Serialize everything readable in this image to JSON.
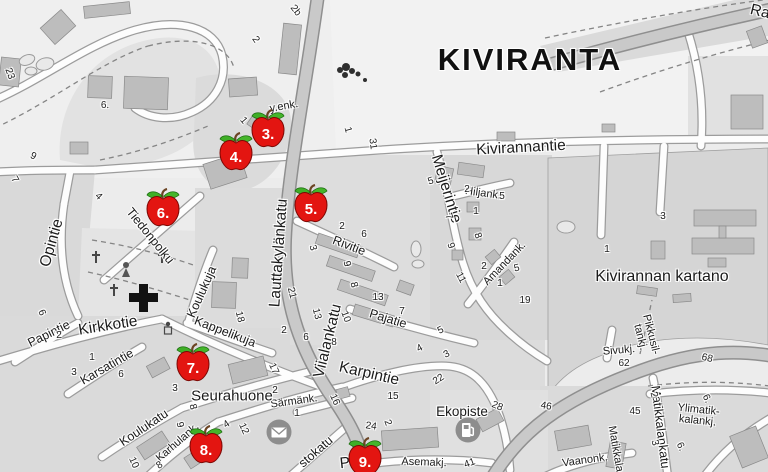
{
  "district": {
    "title": "KIVIRANTA"
  },
  "colors": {
    "apple_red": "#e31511",
    "apple_outline": "#7c0703",
    "leaf_green": "#45b52b",
    "marker_text": "#ffffff",
    "major_road": "#c9c9c9",
    "minor_road": "#fdfdfd",
    "label_text": "#1b1b1b",
    "icon_circle_gray": "#8d8d8d"
  },
  "markers": [
    {
      "num": "3.",
      "x": 268,
      "y": 129
    },
    {
      "num": "4.",
      "x": 236,
      "y": 152
    },
    {
      "num": "5.",
      "x": 311,
      "y": 204
    },
    {
      "num": "6.",
      "x": 163,
      "y": 208
    },
    {
      "num": "7.",
      "x": 193,
      "y": 363
    },
    {
      "num": "8.",
      "x": 206,
      "y": 445
    },
    {
      "num": "9.",
      "x": 365,
      "y": 457
    }
  ],
  "street_labels": [
    {
      "text": "Kivirannantie",
      "x": 521,
      "y": 148,
      "rot": -3,
      "kind": "major"
    },
    {
      "text": "Ra",
      "x": 760,
      "y": 12,
      "rot": 14,
      "kind": "major"
    },
    {
      "text": "Meijerintie",
      "x": 446,
      "y": 189,
      "rot": 73,
      "kind": "major"
    },
    {
      "text": "Hiljank.",
      "x": 483,
      "y": 194,
      "rot": 8,
      "kind": "small"
    },
    {
      "text": "Amandank.",
      "x": 505,
      "y": 264,
      "rot": -46,
      "kind": "small"
    },
    {
      "text": "Kivirannan kartano",
      "x": 662,
      "y": 277,
      "rot": 0,
      "kind": "kartano"
    },
    {
      "text": "Lauttakylänkatu",
      "x": 279,
      "y": 253,
      "rot": -86,
      "kind": "major"
    },
    {
      "text": "Rivitie",
      "x": 349,
      "y": 246,
      "rot": 21,
      "kind": "minor"
    },
    {
      "text": "Pajatie",
      "x": 388,
      "y": 319,
      "rot": 17,
      "kind": "minor"
    },
    {
      "text": "Viialankatu",
      "x": 328,
      "y": 341,
      "rot": -76,
      "kind": "major"
    },
    {
      "text": "Karpintie",
      "x": 369,
      "y": 374,
      "rot": 13,
      "kind": "major"
    },
    {
      "text": "Opintie",
      "x": 52,
      "y": 243,
      "rot": -74,
      "kind": "major"
    },
    {
      "text": "Tiedonpolku",
      "x": 150,
      "y": 236,
      "rot": 51,
      "kind": "minor"
    },
    {
      "text": "Kirkkotie",
      "x": 108,
      "y": 326,
      "rot": -9,
      "kind": "major"
    },
    {
      "text": "Papintie",
      "x": 49,
      "y": 334,
      "rot": -26,
      "kind": "minor"
    },
    {
      "text": "Karsatintie",
      "x": 107,
      "y": 367,
      "rot": -30,
      "kind": "minor"
    },
    {
      "text": "Koulukuja",
      "x": 202,
      "y": 292,
      "rot": -66,
      "kind": "minor"
    },
    {
      "text": "Kappelikuja",
      "x": 225,
      "y": 332,
      "rot": 21,
      "kind": "minor"
    },
    {
      "text": "Koulukatu",
      "x": 144,
      "y": 428,
      "rot": -34,
      "kind": "minor"
    },
    {
      "text": "Karhulank.",
      "x": 178,
      "y": 443,
      "rot": -41,
      "kind": "small"
    },
    {
      "text": "Särmänk.",
      "x": 294,
      "y": 402,
      "rot": -8,
      "kind": "small"
    },
    {
      "text": "Seurahuone",
      "x": 232,
      "y": 396,
      "rot": 0,
      "kind": "poilg"
    },
    {
      "text": "Ekopiste",
      "x": 462,
      "y": 412,
      "rot": 0,
      "kind": "poi"
    },
    {
      "text": "Asemakj.",
      "x": 424,
      "y": 463,
      "rot": 2,
      "kind": "small"
    },
    {
      "text": "y.enk.",
      "x": 284,
      "y": 107,
      "rot": -10,
      "kind": "small"
    },
    {
      "text": "Sivukj.",
      "x": 619,
      "y": 351,
      "rot": -5,
      "kind": "small"
    },
    {
      "text": "Pikkusil-\ntankj.",
      "x": 645,
      "y": 336,
      "rot": 76,
      "kind": "small"
    },
    {
      "text": "Matikkalankatu",
      "x": 660,
      "y": 427,
      "rot": 83,
      "kind": "minor"
    },
    {
      "text": "Matikkala",
      "x": 615,
      "y": 449,
      "rot": 80,
      "kind": "small"
    },
    {
      "text": "Ylimatik-\nkalankj.",
      "x": 698,
      "y": 416,
      "rot": 6,
      "kind": "small"
    },
    {
      "text": "Vaanonk.",
      "x": 585,
      "y": 461,
      "rot": -8,
      "kind": "small"
    },
    {
      "text": "Pol",
      "x": 351,
      "y": 463,
      "rot": -6,
      "kind": "major"
    },
    {
      "text": "stokatu",
      "x": 316,
      "y": 452,
      "rot": -41,
      "kind": "minor"
    }
  ],
  "house_numbers": [
    {
      "text": "2b",
      "x": 295,
      "y": 11,
      "rot": 52
    },
    {
      "text": "2",
      "x": 255,
      "y": 40,
      "rot": 55
    },
    {
      "text": "23",
      "x": 9,
      "y": 74,
      "rot": 70
    },
    {
      "text": "6.",
      "x": 105,
      "y": 106,
      "rot": 0
    },
    {
      "text": "9",
      "x": 33,
      "y": 157,
      "rot": 25
    },
    {
      "text": "7",
      "x": 14,
      "y": 180,
      "rot": 60
    },
    {
      "text": "4",
      "x": 98,
      "y": 197,
      "rot": 45
    },
    {
      "text": "1",
      "x": 243,
      "y": 121,
      "rot": 50
    },
    {
      "text": "1",
      "x": 347,
      "y": 130,
      "rot": 75
    },
    {
      "text": "31",
      "x": 372,
      "y": 144,
      "rot": 82
    },
    {
      "text": "5",
      "x": 431,
      "y": 182,
      "rot": -18
    },
    {
      "text": "2",
      "x": 467,
      "y": 190,
      "rot": 0
    },
    {
      "text": "5",
      "x": 502,
      "y": 197,
      "rot": 0
    },
    {
      "text": "1",
      "x": 476,
      "y": 212,
      "rot": 0
    },
    {
      "text": "7",
      "x": 448,
      "y": 217,
      "rot": 70
    },
    {
      "text": "8",
      "x": 477,
      "y": 236,
      "rot": 70
    },
    {
      "text": "9",
      "x": 450,
      "y": 246,
      "rot": 70
    },
    {
      "text": "2",
      "x": 484,
      "y": 267,
      "rot": 0
    },
    {
      "text": "5",
      "x": 517,
      "y": 269,
      "rot": -12
    },
    {
      "text": "11",
      "x": 460,
      "y": 278,
      "rot": 62
    },
    {
      "text": "1",
      "x": 500,
      "y": 284,
      "rot": 0
    },
    {
      "text": "19",
      "x": 525,
      "y": 301,
      "rot": 0
    },
    {
      "text": "3",
      "x": 663,
      "y": 217,
      "rot": 0
    },
    {
      "text": "1",
      "x": 607,
      "y": 250,
      "rot": 0
    },
    {
      "text": "2",
      "x": 342,
      "y": 227,
      "rot": 0
    },
    {
      "text": "6",
      "x": 364,
      "y": 235,
      "rot": 0
    },
    {
      "text": "3",
      "x": 312,
      "y": 248,
      "rot": 76
    },
    {
      "text": "9",
      "x": 346,
      "y": 264,
      "rot": 76
    },
    {
      "text": "8",
      "x": 353,
      "y": 285,
      "rot": 76
    },
    {
      "text": "21",
      "x": 291,
      "y": 293,
      "rot": 76
    },
    {
      "text": "13",
      "x": 378,
      "y": 298,
      "rot": 0
    },
    {
      "text": "13",
      "x": 316,
      "y": 314,
      "rot": 76
    },
    {
      "text": "10",
      "x": 345,
      "y": 317,
      "rot": 70
    },
    {
      "text": "7",
      "x": 402,
      "y": 312,
      "rot": 0
    },
    {
      "text": "18",
      "x": 239,
      "y": 317,
      "rot": 76
    },
    {
      "text": "2",
      "x": 284,
      "y": 331,
      "rot": 0
    },
    {
      "text": "6",
      "x": 306,
      "y": 338,
      "rot": 0
    },
    {
      "text": "8",
      "x": 334,
      "y": 343,
      "rot": 0
    },
    {
      "text": "5",
      "x": 441,
      "y": 331,
      "rot": -28
    },
    {
      "text": "4",
      "x": 420,
      "y": 349,
      "rot": -28
    },
    {
      "text": "3",
      "x": 447,
      "y": 355,
      "rot": -28
    },
    {
      "text": "22",
      "x": 439,
      "y": 380,
      "rot": -33
    },
    {
      "text": "15",
      "x": 393,
      "y": 397,
      "rot": 0
    },
    {
      "text": "16",
      "x": 334,
      "y": 400,
      "rot": 66
    },
    {
      "text": "2",
      "x": 387,
      "y": 423,
      "rot": 70
    },
    {
      "text": "24",
      "x": 371,
      "y": 427,
      "rot": 8
    },
    {
      "text": "28",
      "x": 497,
      "y": 407,
      "rot": 22
    },
    {
      "text": "1",
      "x": 297,
      "y": 414,
      "rot": 0
    },
    {
      "text": "2",
      "x": 275,
      "y": 391,
      "rot": 0
    },
    {
      "text": "6",
      "x": 121,
      "y": 375,
      "rot": 0
    },
    {
      "text": "3",
      "x": 175,
      "y": 389,
      "rot": 0
    },
    {
      "text": "8",
      "x": 192,
      "y": 407,
      "rot": 76
    },
    {
      "text": "9",
      "x": 179,
      "y": 425,
      "rot": 76
    },
    {
      "text": "17",
      "x": 273,
      "y": 369,
      "rot": 66
    },
    {
      "text": "4",
      "x": 227,
      "y": 425,
      "rot": -33
    },
    {
      "text": "12",
      "x": 243,
      "y": 429,
      "rot": 66
    },
    {
      "text": "10",
      "x": 133,
      "y": 463,
      "rot": 66
    },
    {
      "text": "8",
      "x": 160,
      "y": 466,
      "rot": -33
    },
    {
      "text": "6",
      "x": 41,
      "y": 313,
      "rot": 66
    },
    {
      "text": "2",
      "x": 59,
      "y": 336,
      "rot": 0
    },
    {
      "text": "1",
      "x": 92,
      "y": 358,
      "rot": 0
    },
    {
      "text": "3",
      "x": 74,
      "y": 373,
      "rot": 0
    },
    {
      "text": "46",
      "x": 546,
      "y": 407,
      "rot": 10
    },
    {
      "text": "62",
      "x": 624,
      "y": 364,
      "rot": 0
    },
    {
      "text": "68",
      "x": 707,
      "y": 359,
      "rot": 13
    },
    {
      "text": "45",
      "x": 635,
      "y": 412,
      "rot": 0
    },
    {
      "text": "2",
      "x": 653,
      "y": 395,
      "rot": 76
    },
    {
      "text": "6.",
      "x": 706,
      "y": 399,
      "rot": 64
    },
    {
      "text": "3",
      "x": 654,
      "y": 443,
      "rot": 76
    },
    {
      "text": "6.",
      "x": 680,
      "y": 447,
      "rot": 64
    },
    {
      "text": "41",
      "x": 470,
      "y": 464,
      "rot": -20
    }
  ],
  "icons": [
    {
      "name": "post-office-envelope-icon",
      "x": 279,
      "y": 432
    },
    {
      "name": "fuel-station-pump-icon",
      "x": 468,
      "y": 430
    }
  ]
}
